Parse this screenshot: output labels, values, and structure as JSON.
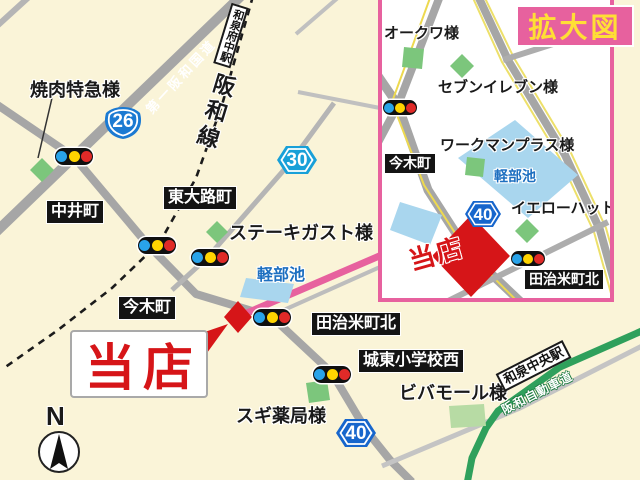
{
  "main_map": {
    "yakiniku_tokkyu": "焼肉特急様",
    "nakai_cho": "中井町",
    "higashi_oji_cho": "東大路町",
    "steak_gusto": "ステーキガスト様",
    "karube_pond": "軽部池",
    "imaki_cho": "今木町",
    "tajime_cho_kita": "田治米町北",
    "joto_shogakko_nishi": "城東小学校西",
    "viva_mall": "ビバモール様",
    "sugi_yakkyoku": "スギ薬局様",
    "izumi_fuchu_station": "和泉府中駅",
    "izumi_chuo_station": "和泉中央駅",
    "hanwa_line": "阪和線",
    "daiichi_hanwa_kokudo": "第一阪和国道",
    "hanwa_expressway": "阪和自動車道",
    "our_store": "当店",
    "compass_north": "N",
    "route26": "26",
    "route30": "30",
    "route40": "40"
  },
  "inset": {
    "title": "拡大図",
    "okuwa": "オークワ様",
    "seven_eleven": "セブンイレブン様",
    "workman_plus": "ワークマンプラス様",
    "karube_pond": "軽部池",
    "yellow_hat": "イエローハット様",
    "imaki_cho": "今木町",
    "tajime_cho_kita": "田治米町北",
    "our_store": "当店",
    "route40": "40"
  },
  "colors": {
    "background": "#FAF4D8",
    "road_gray": "#A6A6A6",
    "pink_accent": "#E7619E",
    "store_red": "#D61518",
    "pond_blue": "#A9D6EE",
    "pond_text_blue": "#1D6FC0",
    "building_green": "#7CC67C",
    "expressway_green": "#2FA05C",
    "route26_blue": "#1B7AD2",
    "route30_blue": "#18A0D8",
    "route40_blue": "#1766CC",
    "kakudai_yellow": "#FFDF35"
  }
}
